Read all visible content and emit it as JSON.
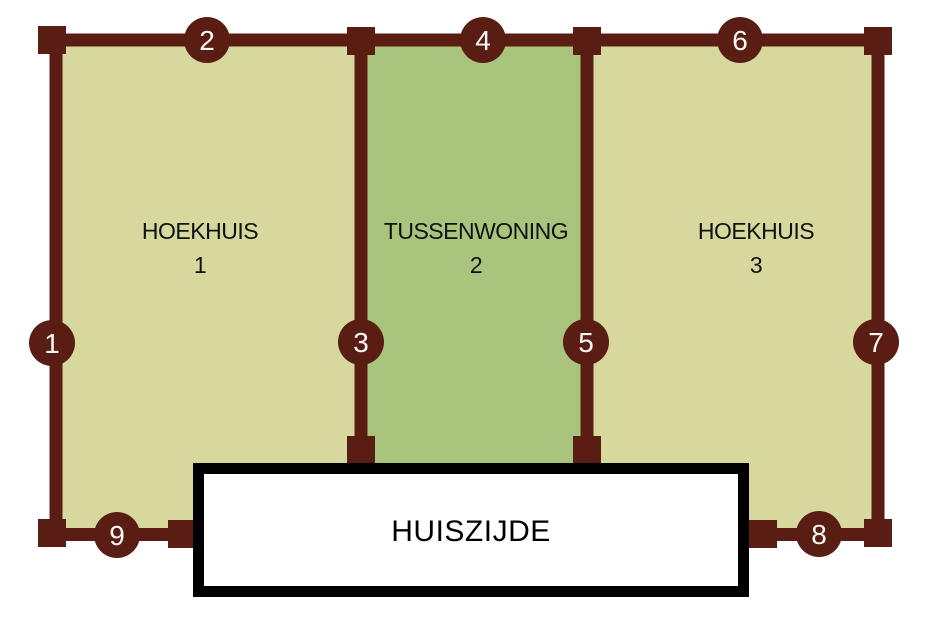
{
  "diagram": {
    "description": "Plot boundary diagram of three adjacent houses with numbered fence sections",
    "colors": {
      "background": "#ffffff",
      "boundary_line": "#5a1d13",
      "corner_plot_fill": "#d7d89e",
      "middle_plot_fill": "#a9c57d",
      "marker_number_text": "#faf8f5",
      "label_text": "#111111",
      "house_box_fill": "#ffffff",
      "house_box_border": "#000000"
    },
    "sections": [
      {
        "label": "HOEKHUIS",
        "number": "1"
      },
      {
        "label": "TUSSENWONING",
        "number": "2"
      },
      {
        "label": "HOEKHUIS",
        "number": "3"
      }
    ],
    "markers": [
      "1",
      "2",
      "3",
      "4",
      "5",
      "6",
      "7",
      "8",
      "9"
    ],
    "house_side": {
      "label": "HUISZIJDE"
    }
  }
}
